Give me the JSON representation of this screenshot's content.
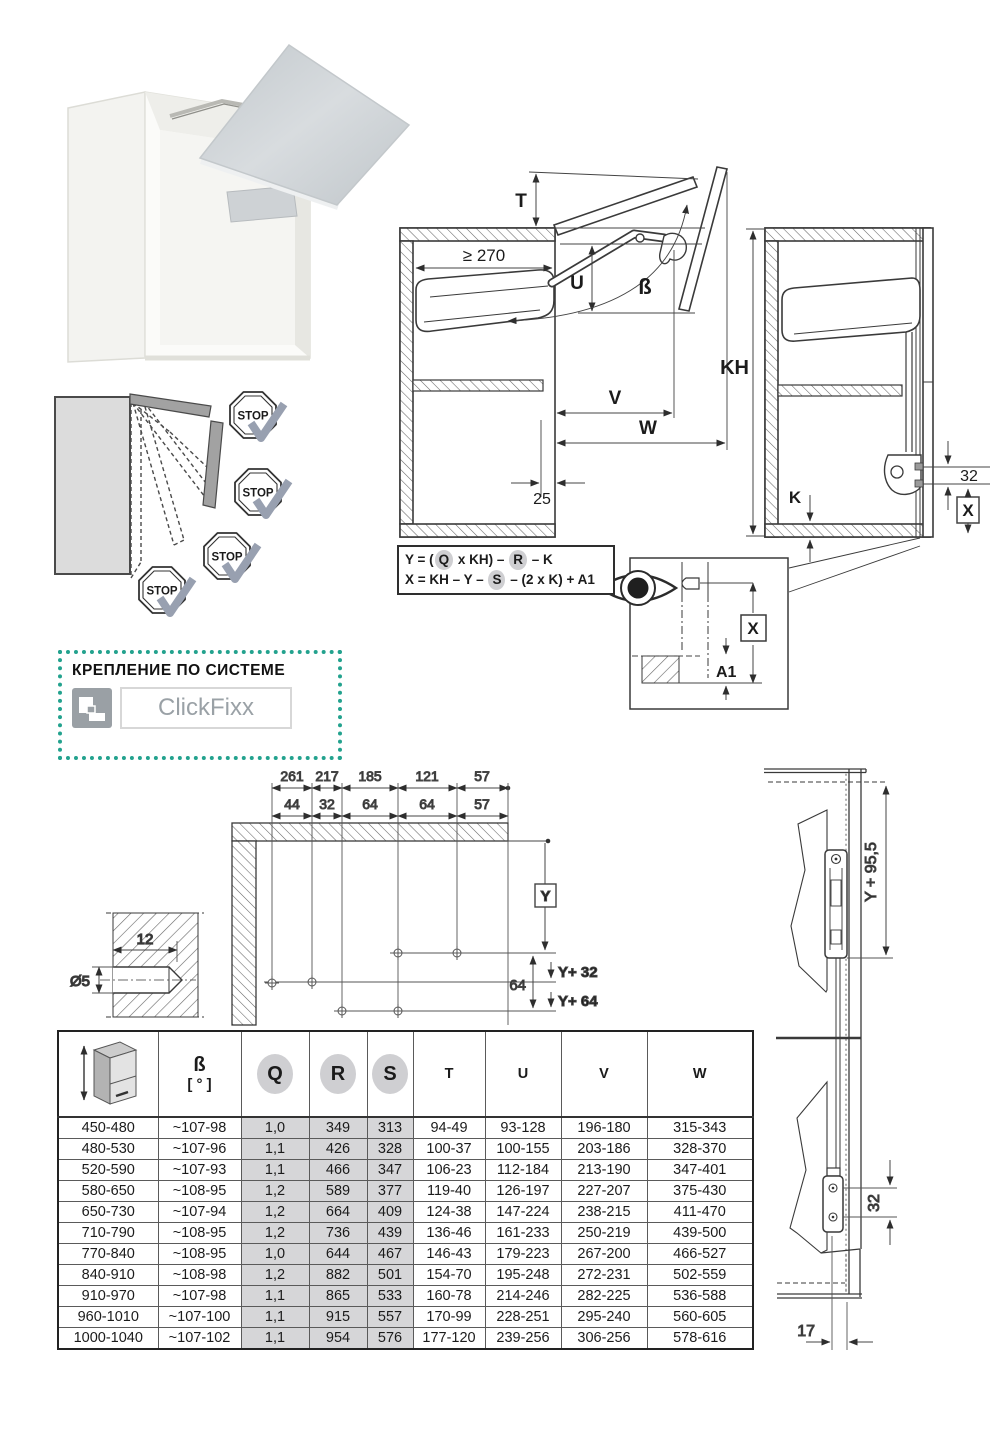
{
  "page": {
    "background": "#ffffff",
    "accent_teal": "#23a28e",
    "shade_gray": "#d6d6d8"
  },
  "clickfixx": {
    "heading": "КРЕПЛЕНИЕ ПО СИСТЕМЕ",
    "brand": "ClickFixx"
  },
  "stop_diagram": {
    "labels": [
      "STOP",
      "STOP",
      "STOP",
      "STOP"
    ]
  },
  "main_diagram": {
    "labels": {
      "t": "T",
      "min_width": "≥ 270",
      "u": "U",
      "beta": "ß",
      "v": "V",
      "w": "W",
      "offset25": "25",
      "kh": "KH",
      "k": "K",
      "d32": "32",
      "x": "X"
    }
  },
  "formulas": {
    "line1": [
      {
        "t": "Y = ("
      },
      {
        "t": "Q",
        "c": true
      },
      {
        "t": " x KH) – "
      },
      {
        "t": "R",
        "c": true
      },
      {
        "t": " – K"
      }
    ],
    "line2": [
      {
        "t": "X = KH – Y – "
      },
      {
        "t": "S",
        "c": true
      },
      {
        "t": " – (2 x K) + A1"
      }
    ]
  },
  "eye_diagram": {
    "x": "X",
    "a1": "A1"
  },
  "drilling": {
    "row1": [
      "261",
      "217",
      "185",
      "121",
      "57"
    ],
    "row2": [
      "44",
      "32",
      "64",
      "64",
      "57"
    ],
    "y": "Y",
    "d64": "64",
    "y32": "Y+ 32",
    "y64": "Y+ 64",
    "depth": "12",
    "dia": "Ø5"
  },
  "side_diagram": {
    "y955": "Y + 95,5",
    "d32": "32",
    "d17": "17"
  },
  "table": {
    "col_keys": [
      "kh",
      "beta",
      "q",
      "r",
      "s",
      "t",
      "u",
      "v",
      "w"
    ],
    "shaded_keys": [
      "q",
      "r",
      "s"
    ],
    "headers": {
      "beta_top": "ß",
      "beta_unit": "[ ° ]",
      "q": "Q",
      "r": "R",
      "s": "S",
      "t": "T",
      "u": "U",
      "v": "V",
      "w": "W"
    },
    "rows": [
      {
        "kh": "450-480",
        "beta": "~107-98",
        "q": "1,0",
        "r": "349",
        "s": "313",
        "t": "94-49",
        "u": "93-128",
        "v": "196-180",
        "w": "315-343"
      },
      {
        "kh": "480-530",
        "beta": "~107-96",
        "q": "1,1",
        "r": "426",
        "s": "328",
        "t": "100-37",
        "u": "100-155",
        "v": "203-186",
        "w": "328-370"
      },
      {
        "kh": "520-590",
        "beta": "~107-93",
        "q": "1,1",
        "r": "466",
        "s": "347",
        "t": "106-23",
        "u": "112-184",
        "v": "213-190",
        "w": "347-401"
      },
      {
        "kh": "580-650",
        "beta": "~108-95",
        "q": "1,2",
        "r": "589",
        "s": "377",
        "t": "119-40",
        "u": "126-197",
        "v": "227-207",
        "w": "375-430"
      },
      {
        "kh": "650-730",
        "beta": "~107-94",
        "q": "1,2",
        "r": "664",
        "s": "409",
        "t": "124-38",
        "u": "147-224",
        "v": "238-215",
        "w": "411-470"
      },
      {
        "kh": "710-790",
        "beta": "~108-95",
        "q": "1,2",
        "r": "736",
        "s": "439",
        "t": "136-46",
        "u": "161-233",
        "v": "250-219",
        "w": "439-500"
      },
      {
        "kh": "770-840",
        "beta": "~108-95",
        "q": "1,0",
        "r": "644",
        "s": "467",
        "t": "146-43",
        "u": "179-223",
        "v": "267-200",
        "w": "466-527"
      },
      {
        "kh": "840-910",
        "beta": "~108-98",
        "q": "1,2",
        "r": "882",
        "s": "501",
        "t": "154-70",
        "u": "195-248",
        "v": "272-231",
        "w": "502-559"
      },
      {
        "kh": "910-970",
        "beta": "~107-98",
        "q": "1,1",
        "r": "865",
        "s": "533",
        "t": "160-78",
        "u": "214-246",
        "v": "282-225",
        "w": "536-588"
      },
      {
        "kh": "960-1010",
        "beta": "~107-100",
        "q": "1,1",
        "r": "915",
        "s": "557",
        "t": "170-99",
        "u": "228-251",
        "v": "295-240",
        "w": "560-605"
      },
      {
        "kh": "1000-1040",
        "beta": "~107-102",
        "q": "1,1",
        "r": "954",
        "s": "576",
        "t": "177-120",
        "u": "239-256",
        "v": "306-256",
        "w": "578-616"
      }
    ]
  }
}
